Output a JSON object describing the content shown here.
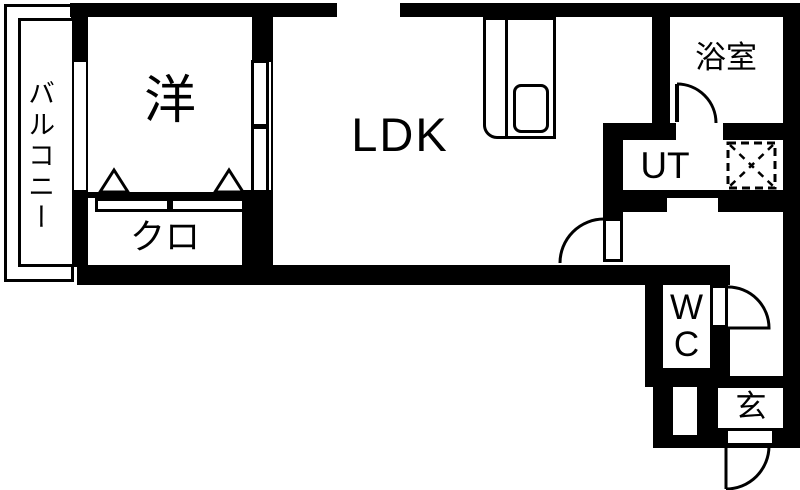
{
  "plan": {
    "kind": "apartment-floor-plan",
    "rooms": {
      "balcony": {
        "label": "バルコニー"
      },
      "western": {
        "label": "洋"
      },
      "ldk": {
        "label": "LDK"
      },
      "closet": {
        "label": "クロ"
      },
      "bathroom": {
        "label": "浴室"
      },
      "utility": {
        "label": "UT"
      },
      "wc": {
        "lines": [
          "W",
          "C"
        ]
      },
      "entrance": {
        "label": "玄"
      }
    },
    "colors": {
      "wall": "#000000",
      "floor": "#ffffff"
    }
  }
}
